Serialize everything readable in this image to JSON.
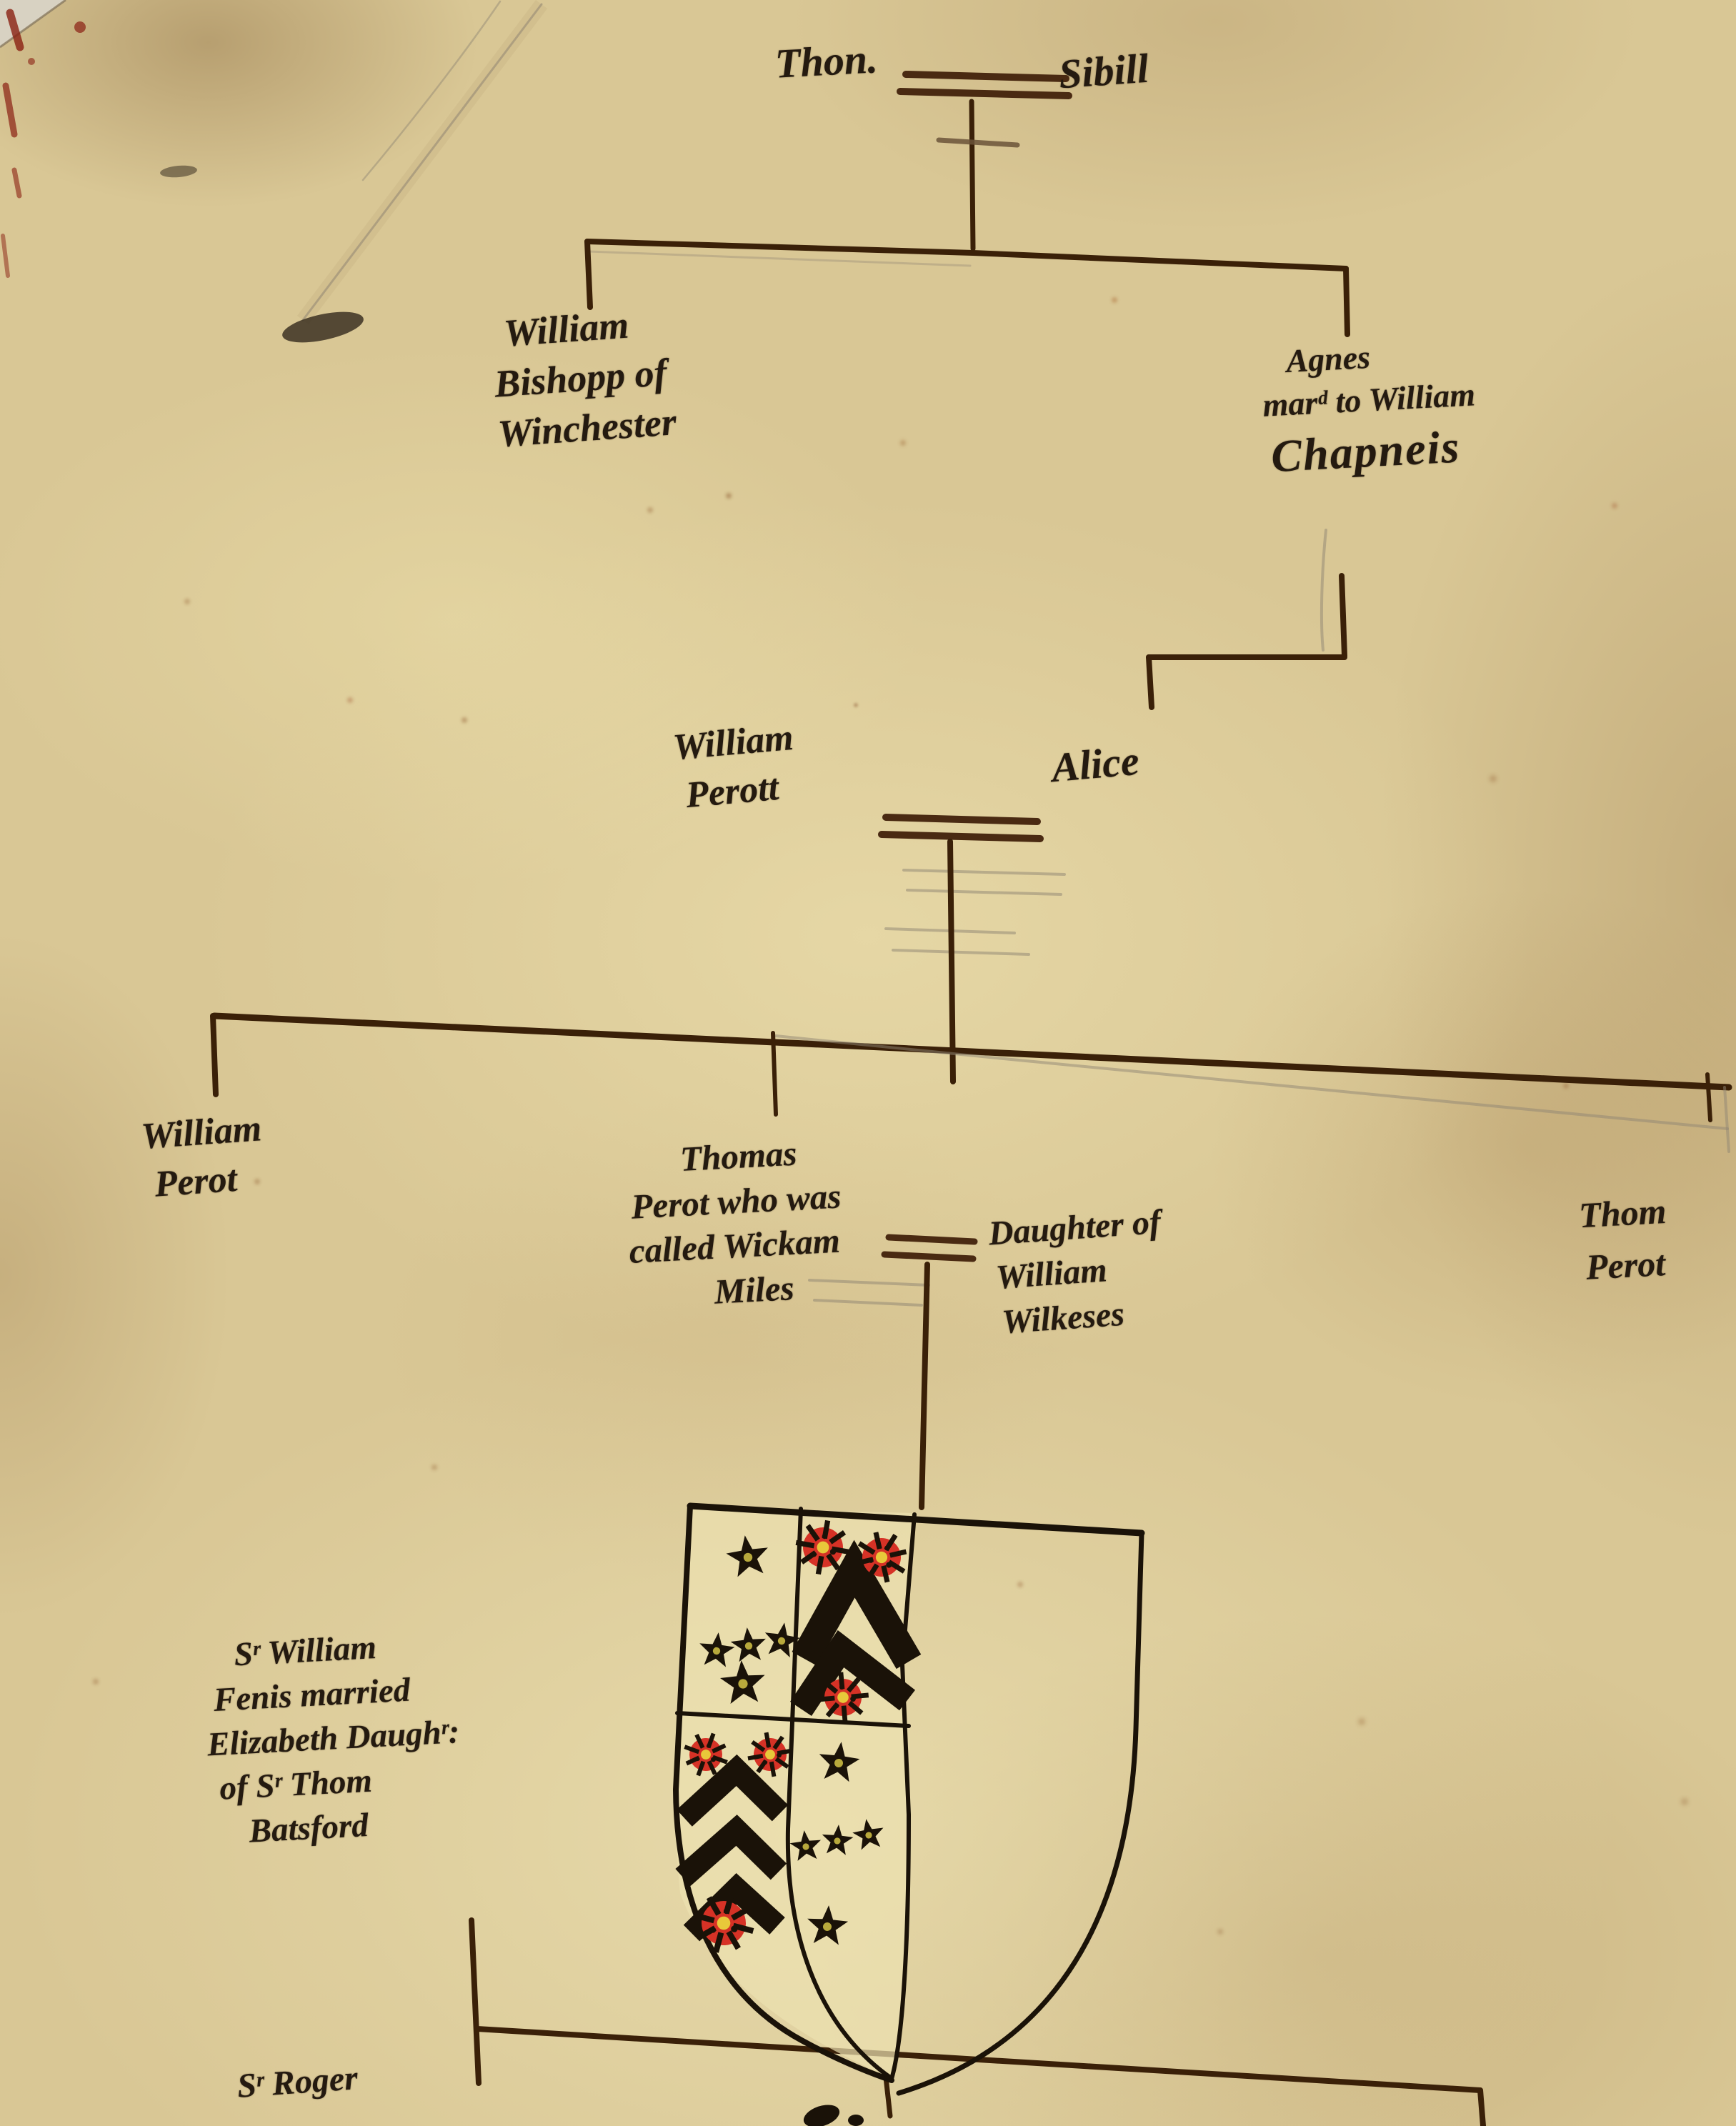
{
  "document": {
    "kind": "handwritten genealogical pedigree on aged parchment",
    "script_style": "17th-century cursive ink handwriting"
  },
  "palette": {
    "parchment": "#d9c795",
    "parchment_light": "#efe4ba",
    "parchment_dark": "#b89c6e",
    "ink_text": "#241a10",
    "ink_line": "#3a2008",
    "ink_marriage": "#4a2a12",
    "pencil": "#8f8573",
    "heraldic_black": "#1a1208",
    "rose_red": "#d63226",
    "rose_center": "#e8c83a",
    "star_center": "#b8a93c",
    "shield_field": "#ece1b0",
    "crayon_red": "#8a2012",
    "crease": "#8d7c5c",
    "smudge": "#2e2418"
  },
  "tree": {
    "gen1": {
      "husband": "Thon.",
      "wife": "Sibill"
    },
    "gen2": {
      "left": {
        "lines": [
          "William",
          "Bishopp of",
          "Winchester"
        ]
      },
      "right": {
        "lines": [
          "Agnes",
          "marᵈ to William",
          "Chapneis"
        ]
      }
    },
    "gen3": {
      "husband": {
        "lines": [
          "William",
          "Perott"
        ]
      },
      "wife": "Alice"
    },
    "gen4": {
      "left": {
        "lines": [
          "William",
          "Perot"
        ]
      },
      "middle": {
        "lines": [
          "Thomas",
          "Perot who was",
          "called Wickam",
          "Miles"
        ]
      },
      "middle_spouse": {
        "lines": [
          "Daughter of",
          "William",
          "Wilkeses"
        ]
      },
      "right": {
        "lines": [
          "Thom",
          "Perot"
        ]
      }
    },
    "side_note": {
      "lines": [
        "Sʳ William",
        "Fenis married",
        "Elizabeth Daughʳ:",
        "of Sʳ Thom",
        "Batsford"
      ]
    },
    "gen5": {
      "left": "Sʳ Roger"
    }
  },
  "shield": {
    "structure": "quartered arms drawn in left half of a larger blank shield outline",
    "quarters": [
      {
        "position": 1,
        "blazon": "five black mullets arranged 1-3-1"
      },
      {
        "position": 2,
        "blazon": "two black chevrons between three red roses (two above, one below)"
      },
      {
        "position": 3,
        "blazon": "three black chevrons with two red roses above and one red rose below"
      },
      {
        "position": 4,
        "blazon": "five black mullets arranged 1-3-1"
      }
    ]
  }
}
